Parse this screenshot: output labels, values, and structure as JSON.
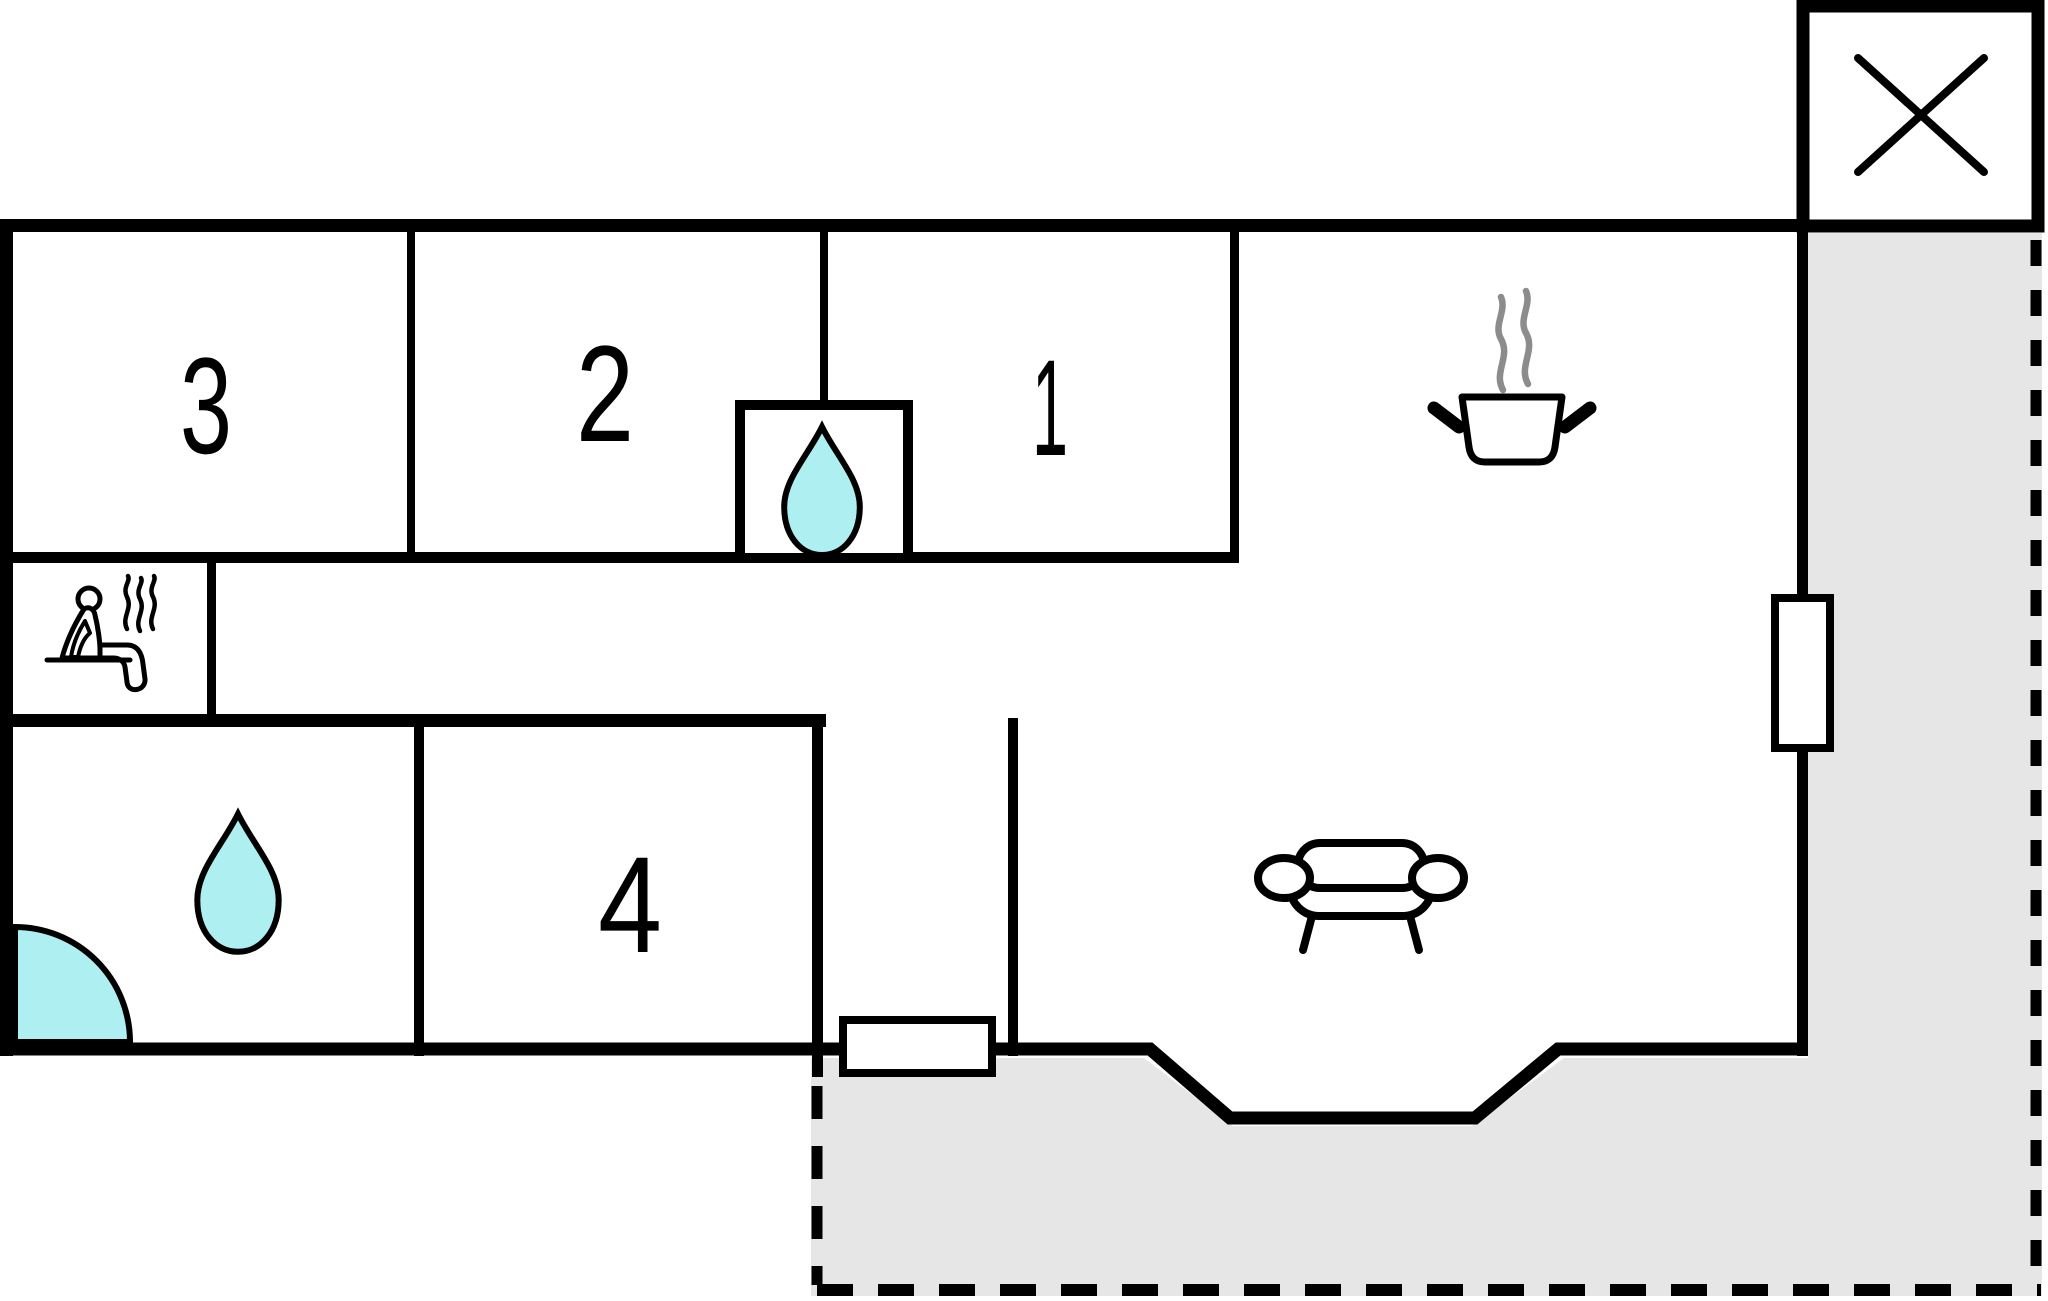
{
  "page": {
    "type": "floor-plan",
    "background_color": "#ffffff"
  },
  "colors": {
    "wall": "#000000",
    "water": "#aeeff2",
    "terrace": "#e6e6e6",
    "steam_gray": "#8c8c8c",
    "bg": "#ffffff"
  },
  "room_labels": {
    "room1": "1",
    "room2": "2",
    "room3": "3",
    "room4": "4"
  },
  "icons": {
    "chimney": "crossed-box-chimney-icon",
    "sauna": "sauna-person-steam-icon",
    "shower_cell": "water-drop-icon",
    "bathroom": "water-drop-icon",
    "kitchen": "steaming-pot-icon",
    "living_room": "sofa-icon",
    "entrance": "door-swing-arc-icon",
    "window_right": "window-symbol",
    "window_bottom": "window-symbol",
    "terrace": "dashed-terrace-area"
  }
}
